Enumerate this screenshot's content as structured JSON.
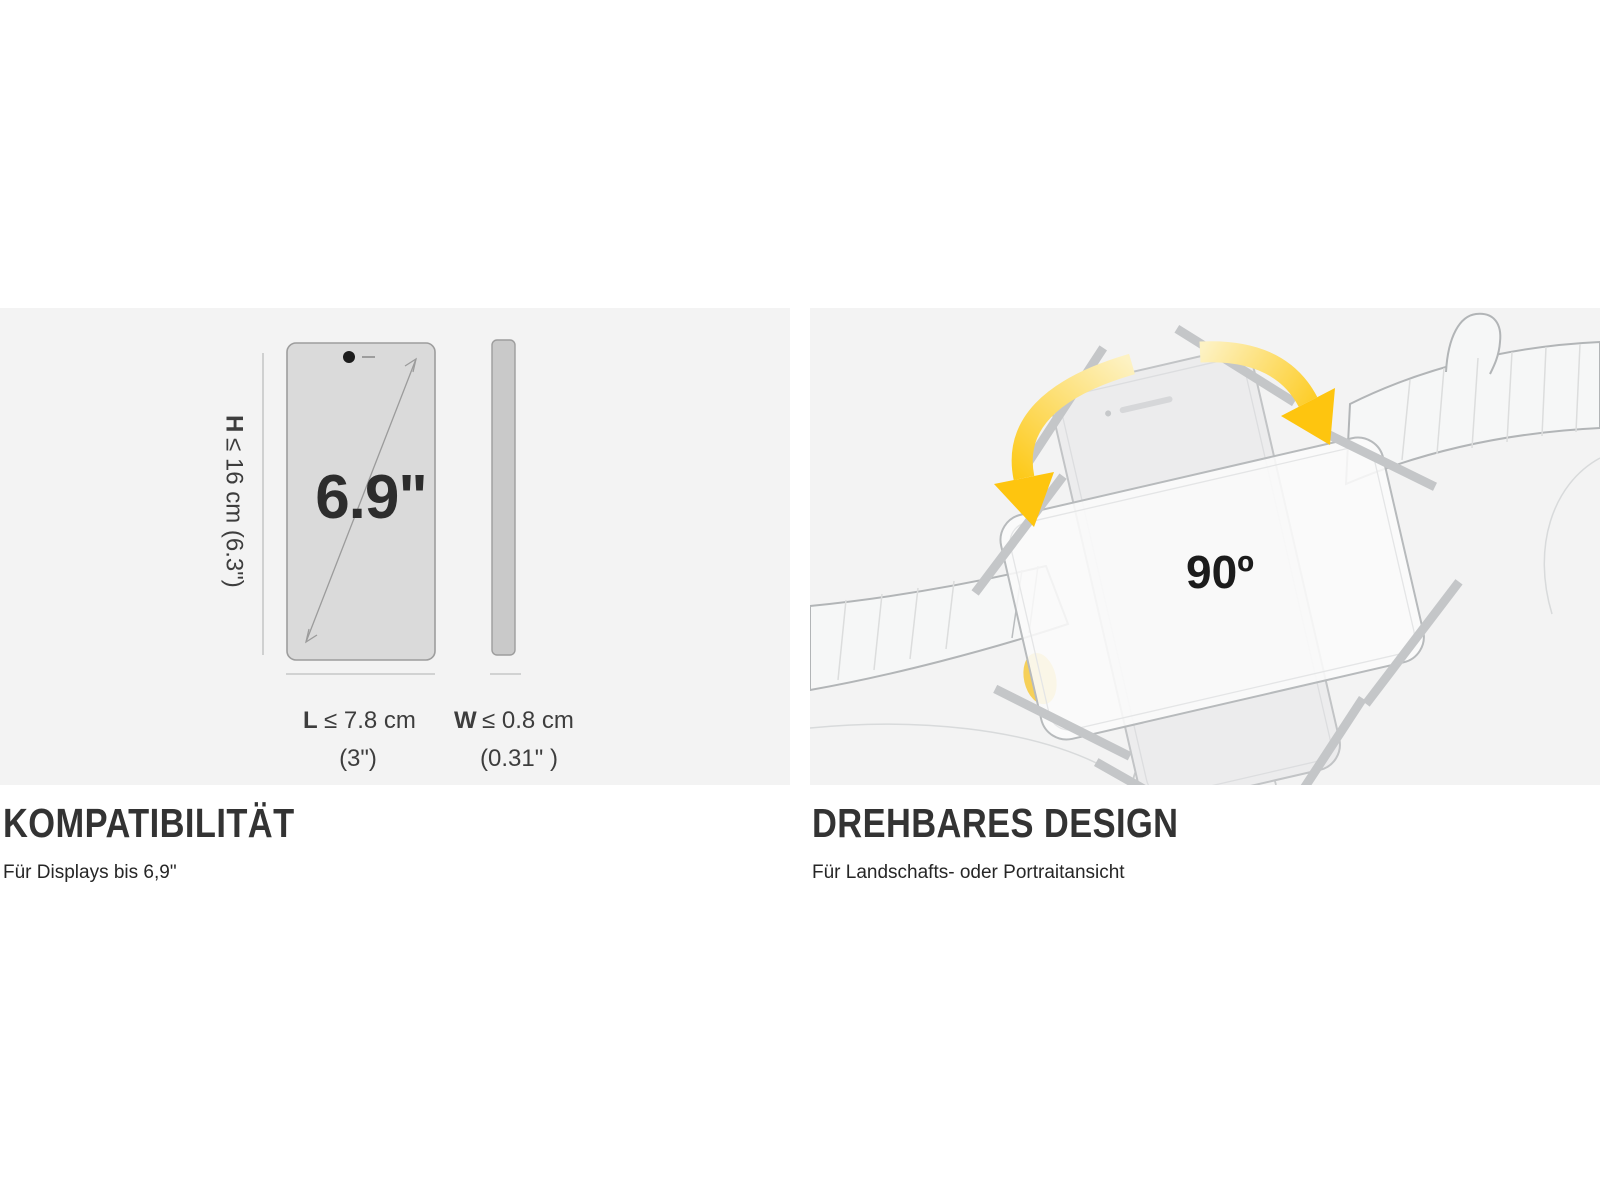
{
  "panels": {
    "compatibility": {
      "heading": "KOMPATIBILITÄT",
      "caption": "Für Displays bis 6,9\"",
      "diagram": {
        "screen_size": "6.9\"",
        "height_label_prefix": "H",
        "height_label_rest": "≤ 16 cm (6.3\")",
        "length_label_prefix": "L",
        "length_label_rest": "≤  7.8 cm",
        "length_label_sub": "(3\")",
        "width_label_prefix": "W",
        "width_label_rest": "≤ 0.8 cm",
        "width_label_sub": "(0.31\" )"
      }
    },
    "rotatable": {
      "heading": "DREHBARES DESIGN",
      "caption": "Für Landschafts- oder Portraitansicht",
      "diagram": {
        "rotation_label": "90º"
      }
    }
  },
  "colors": {
    "panel_background": "#f3f3f3",
    "accent_yellow": "#fec50f",
    "heading_text": "#333333",
    "diagram_text": "#3d3d3d",
    "phone_front_fill": "#dadada",
    "sketch_line": "#b2b5b7"
  }
}
